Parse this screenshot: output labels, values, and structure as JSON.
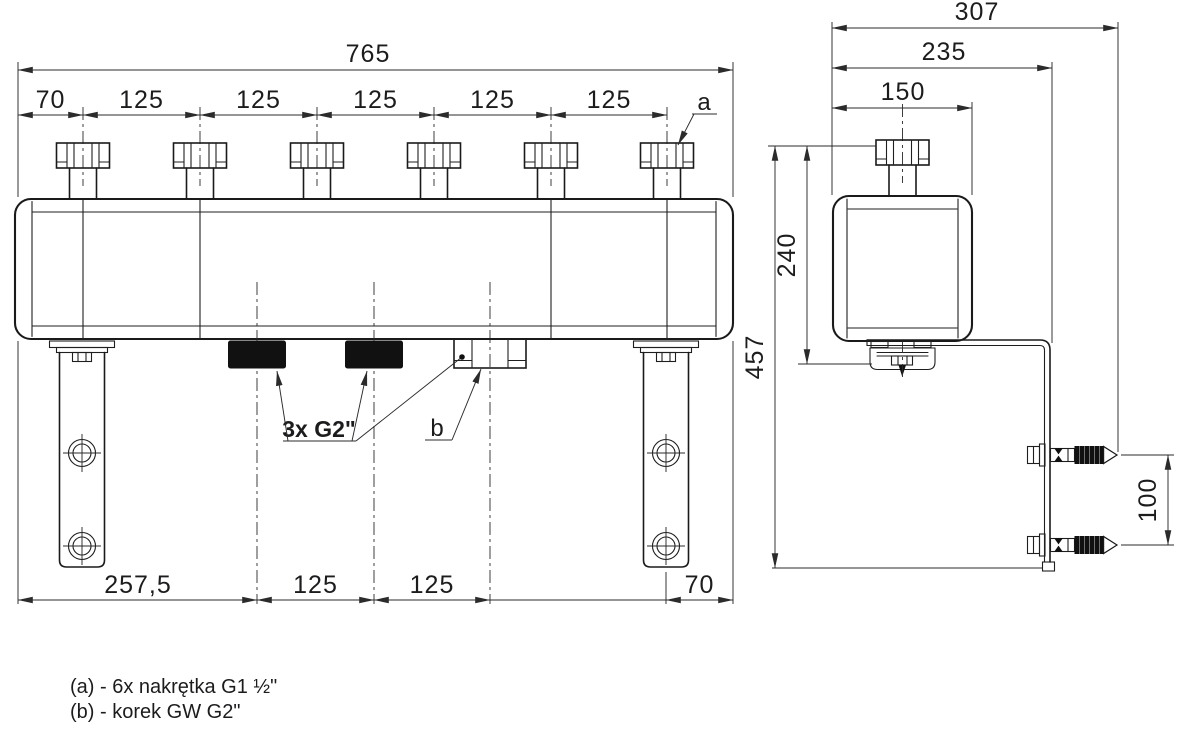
{
  "drawing": {
    "front": {
      "dim_total_width": "765",
      "dim_left_offset": "70",
      "pitches": [
        "125",
        "125",
        "125",
        "125",
        "125"
      ],
      "dim_bottom_left": "257,5",
      "dim_bottom_pitch1": "125",
      "dim_bottom_pitch2": "125",
      "dim_bottom_right": "70",
      "label_a": "a",
      "label_b": "b",
      "label_ports": "3x G2\""
    },
    "side": {
      "dim_total_depth": "307",
      "dim_bracket_depth": "235",
      "dim_body_depth": "150",
      "dim_body_height": "240",
      "dim_total_height": "457",
      "dim_anchor_spacing": "100"
    },
    "legend": {
      "line_a": "(a) - 6x nakrętka G1 ½\"",
      "line_b": "(b) - korek GW G2\""
    }
  }
}
